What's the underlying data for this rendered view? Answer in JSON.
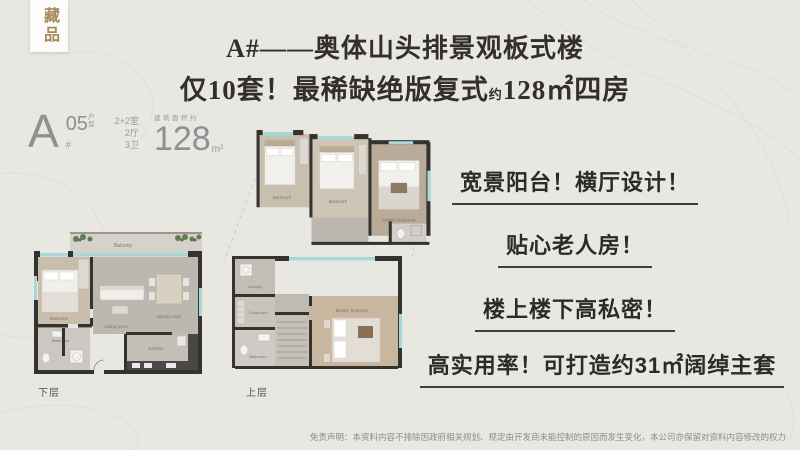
{
  "seal": {
    "text": "藏品"
  },
  "title": {
    "line1": "A#——奥体山头排景观板式楼",
    "line2_pre": "仅10套！最稀缺绝版复式",
    "line2_small": "约",
    "line2_post": "128㎡四房"
  },
  "unit": {
    "block": "A",
    "hash": "#",
    "number": "05",
    "number_suffix": "户型",
    "layout_rooms": "2+2室",
    "layout_halls": "2厅",
    "layout_baths": "3卫",
    "area_label": "建筑面积约",
    "area_value": "128",
    "area_unit": "m²"
  },
  "floor_labels": {
    "lower": "下层",
    "upper": "上层"
  },
  "plan_rooms": {
    "mid": {
      "bed1": "Bedroom",
      "bed2": "Bedroom",
      "master": "Master bedroom"
    },
    "lower": {
      "balcony": "Balcony",
      "bedroom": "Bedroom",
      "living": "Living room",
      "dining": "Dining room",
      "kitchen": "Kitchen",
      "bath": "Bathroom"
    },
    "upper": {
      "laundry": "Laundry",
      "cloak": "Cloakroom",
      "bath": "Bathroom",
      "master": "Master bedroom"
    }
  },
  "selling_points": [
    "宽景阳台！横厅设计！",
    "贴心老人房！",
    "楼上楼下高私密！",
    "高实用率！可打造约31㎡阔绰主套"
  ],
  "disclaimer": "免责声明：本资料内容不排除因政府相关规划、规定由开发商未能控制的原因而发生变化，本公司亦保留对资料内容修改的权力",
  "colors": {
    "background": "#e9e7e2",
    "title_text": "#33302c",
    "seal_text": "#a8895c",
    "underline": "#3f3e3c",
    "muted_gray": "#8f9092",
    "glass": "#a6d8da",
    "wall": "#35332f"
  }
}
